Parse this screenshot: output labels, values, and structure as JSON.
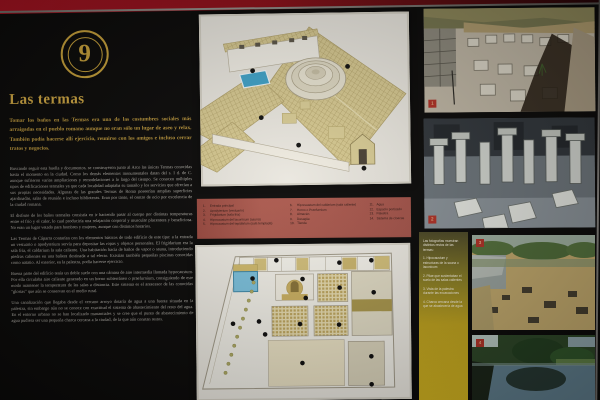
{
  "panel": {
    "number": "9",
    "title": "Las termas",
    "intro": "Tomar los baños en las Termas era una de las costumbres sociales más arraigadas en el pueblo romano aunque no eran sólo un lugar de aseo y relax. También podía hacerse allí ejercicio, reunirse con los amigos e incluso cerrar tratos y negocios.",
    "paragraphs": [
      "Buscando seguir esta huella y documentos, se construyeron junto al Arco las únicas Termas conocidas hasta el momento en la ciudad. Como los demás elementos monumentales datan del s. I d. de C. aunque sufrieron varias ampliaciones y remodelaciones a lo largo del tiempo. Se conocen múltiples tipos de edificaciones termales ya que cada localidad adaptaba su tamaño y los servicios que ofrecían a sus propias necesidades. Algunas de las grandes Termas de Roma poseerían amplias superficies ajardinadas, salas de reunión e incluso bibliotecas. Eran por tanto, el centro de ocio por excelencia de la ciudad romana.",
      "El disfrute de los baños termales consistía en ir haciendo pasar al cuerpo por distintas temperaturas entre el frío y el calor, lo cual produciría una relajación corporal y muscular placentera y beneficiosa. No eran un lugar vetado para hombres y mujeres, aunque con distintos horarios.",
      "Las Termas de Cáparra contarían con los elementos básicos de todo edificio de este tipo: a la entrada un vestuario o apodyterium servía para depositar las ropas y objetos personales. El frigidarium era la sala fría, el caldarium la sala caliente. Una habitación hacía de baños de vapor o sauna, introduciendo piedras calientes en una bañera destinada a tal efecto. Existían también pequeñas piscinas conocidas como natatio. Al exterior, en la palestra, podía hacerse ejercicio.",
      "Buena parte del edificio tenía un doble suelo con una cámara de aire intermedia llamada hypocaustum. Por ella circulaba aire caliente generado en un horno subterráneo o praefurnium, consiguiendo de este modo mantener la temperatura de las salas a distancia. Este sistema es el antecesor de las conocidas \"glorias\" que aún se conservan en el medio rural.",
      "Una canalización que llegaba desde el cercano arroyo dotaría de agua a una fuente situada en la palestra, sin embargo aún no se conoce con exactitud el sistema de abastecimiento del resto del agua. En el entorno urbano no se han localizado manantiales y se cree que el punto de abastecimiento de agua pudiera ser una pequeña charca cercana a la ciudad, de la que aún constan restos."
    ]
  },
  "legend": {
    "columns": [
      [
        {
          "n": "1.",
          "label": "Entrada principal"
        },
        {
          "n": "2.",
          "label": "Apodyterium (vestuario)"
        },
        {
          "n": "3.",
          "label": "Frigidarium (sala fría)"
        },
        {
          "n": "4.",
          "label": "Hipocaustum del laconicum (sauna)"
        },
        {
          "n": "5.",
          "label": "Hipocaustum del tepidarium (sala templada)"
        }
      ],
      [
        {
          "n": "6.",
          "label": "Hipocaustum del caldarium (sala caliente)"
        },
        {
          "n": "7.",
          "label": "Horno o Praefurnium"
        },
        {
          "n": "8.",
          "label": "Almacén"
        },
        {
          "n": "9.",
          "label": "Desagüe"
        },
        {
          "n": "10.",
          "label": "Tienda"
        }
      ],
      [
        {
          "n": "11.",
          "label": "Agua"
        },
        {
          "n": "12.",
          "label": "Espacio porticado"
        },
        {
          "n": "13.",
          "label": "Palestra"
        },
        {
          "n": "14.",
          "label": "Sistema de cloacas"
        }
      ]
    ]
  },
  "photo_captions": {
    "items": [
      "Las fotografías muestran distintos restos de las termas:",
      "1. Hipocaustum y estructuras de la sauna o laconicum",
      "2. Pilae que sustentaban el suelo de las salas calientes",
      "3. Vista de la palestra durante las excavaciones",
      "4. Charca cercana desde la que se abastecería de agua"
    ]
  },
  "photos": [
    {
      "number": "1",
      "alt": "Restos excavados del hipocaustum circular"
    },
    {
      "number": "2",
      "alt": "Pilae de piedra del hipocaustum"
    },
    {
      "number": "3",
      "alt": "Vista general de la excavación y el paisaje"
    },
    {
      "number": "4",
      "alt": "Charca con árboles reflejados"
    }
  ],
  "colors": {
    "gold": "#c9a23a",
    "legend_red": "#a5544a",
    "caption_yellow": "#c9a81f",
    "pool_blue": "#4aa7cd",
    "wall_red": "#8c0f18"
  }
}
